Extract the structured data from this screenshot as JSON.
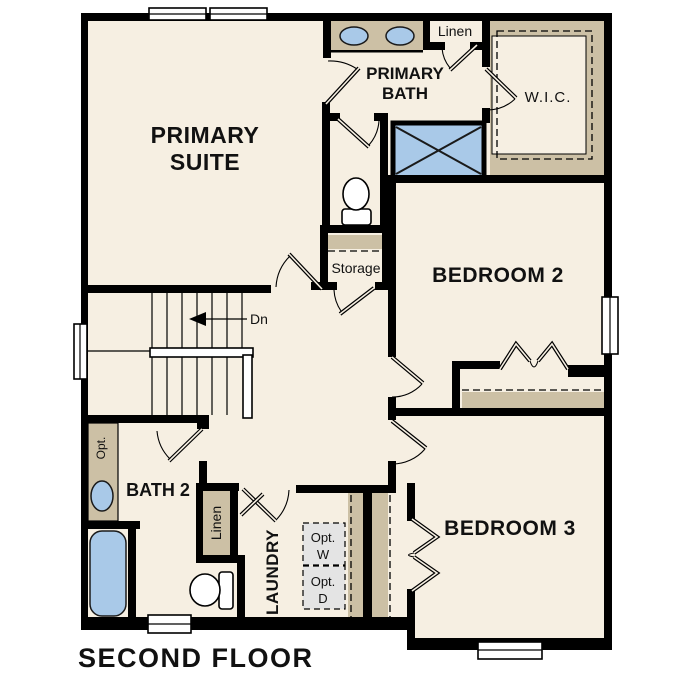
{
  "floor_title": "SECOND FLOOR",
  "rooms": {
    "primary_suite": {
      "line1": "PRIMARY",
      "line2": "SUITE"
    },
    "primary_bath": {
      "line1": "PRIMARY",
      "line2": "BATH"
    },
    "walk_in_closet": {
      "label": "W.I.C."
    },
    "bedroom_2": {
      "label": "BEDROOM 2"
    },
    "bedroom_3": {
      "label": "BEDROOM 3"
    },
    "bath_2": {
      "label": "BATH 2"
    },
    "laundry": {
      "label": "LAUNDRY"
    },
    "storage": {
      "label": "Storage"
    },
    "linen_upper": {
      "label": "Linen"
    },
    "linen_lower": {
      "label": "Linen"
    }
  },
  "annotations": {
    "stairs_direction": "Dn",
    "optional_washer": {
      "line1": "Opt.",
      "line2": "W"
    },
    "optional_dryer": {
      "line1": "Opt.",
      "line2": "D"
    },
    "optional_counter": "Opt."
  },
  "colors": {
    "wall": "#000000",
    "floor": "#F6EFE2",
    "casework": "#CCC0A5",
    "fixture": "#A9C9E8",
    "appliance-box": "#E4E4E4"
  }
}
